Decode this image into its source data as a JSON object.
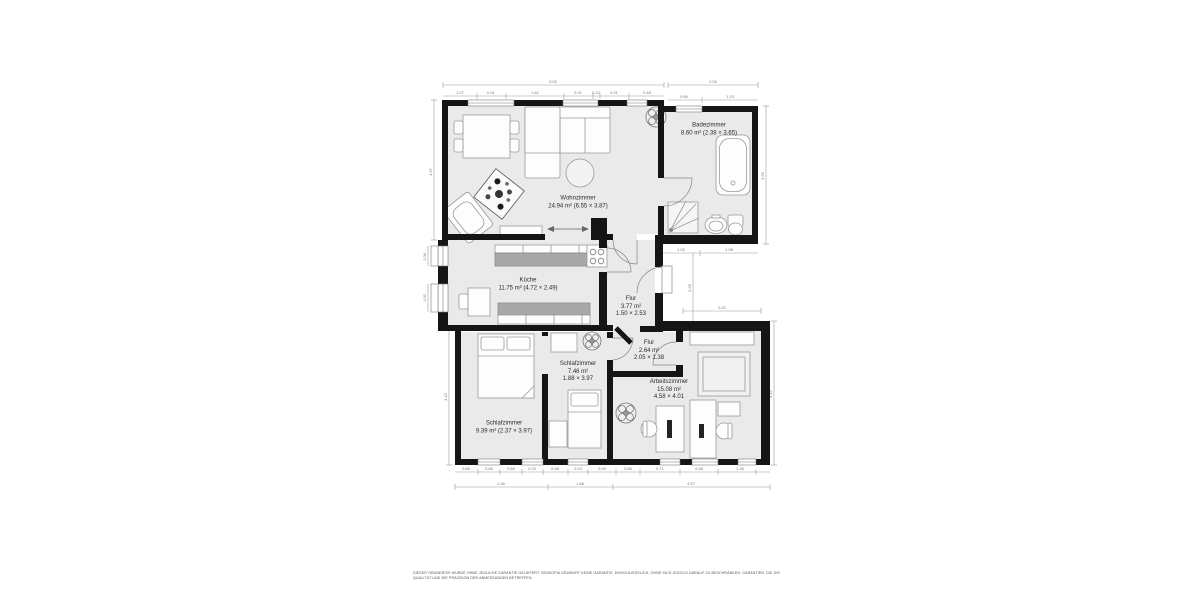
{
  "plan": {
    "rooms": {
      "wohnzimmer": {
        "name": "Wohnzimmer",
        "info": "24.94 m² (6.55 × 3.87)"
      },
      "badezimmer": {
        "name": "Badezimmer",
        "info": "8.60 m² (2.38 × 3.65)"
      },
      "kueche": {
        "name": "Küche",
        "info": "11.75 m² (4.72 × 2.49)"
      },
      "flur1": {
        "name": "Flur",
        "area": "3.77 m²",
        "size": "1.50 × 2.53"
      },
      "flur2": {
        "name": "Flur",
        "area": "2.64 m²",
        "size": "2.05 × 1.38"
      },
      "schlafzimmer_klein": {
        "name": "Schlafzimmer",
        "area": "7.46 m²",
        "size": "1.88 × 3.97"
      },
      "arbeitszimmer": {
        "name": "Arbeitszimmer",
        "area": "15.08 m²",
        "size": "4.58 × 4.01"
      },
      "schlafzimmer_gross": {
        "name": "Schlafzimmer",
        "info": "9.39 m² (2.37 × 3.97)"
      }
    },
    "dimensions": {
      "top_total": "6.93",
      "top_segments": [
        "1.07",
        "0.91",
        "1.82",
        "0.91",
        "0.22",
        "0.91",
        "0.48"
      ],
      "bath_total": "2.56",
      "bath_segments": [
        "0.85",
        "1.23"
      ],
      "right_bath": "3.65",
      "left_upper": "4.37",
      "left_kitchen_windows": [
        "1.08",
        "1.00"
      ],
      "niche_top": [
        "1.00",
        "1.98"
      ],
      "niche_vertical": "2.28",
      "niche_bottom": "2.02",
      "left_lower": "4.42",
      "right_lower": "4.42",
      "bottom_segments": [
        "0.66",
        "0.86",
        "0.66",
        "0.23",
        "0.98",
        "0.23",
        "0.93",
        "0.86",
        "0.71",
        "0.98",
        "1.38"
      ],
      "bottom_totals": [
        "2.36",
        "1.88",
        "4.57"
      ]
    },
    "disclaimer_line1": "DIESER GRUNDRISS WURDE OHNE JEGLICHE GARANTIE GELIEFERT. SENSOPIA GEWÄHRT KEINE GARANTIE, EINSCHLIESSLICH, OHNE SICH JEDOCH DARAUF ZU BESCHRÄNKEN, GARANTIEN, DIE DIE",
    "disclaimer_line2": "QUALITÄT UND DIE PRÄZISION DER ABMESSUNGEN BETREFFEN.",
    "colors": {
      "wall": "#151515",
      "room_fill": "#eaeaea",
      "worktop": "#a8a8a8",
      "dimension": "#7a7a7a"
    }
  }
}
